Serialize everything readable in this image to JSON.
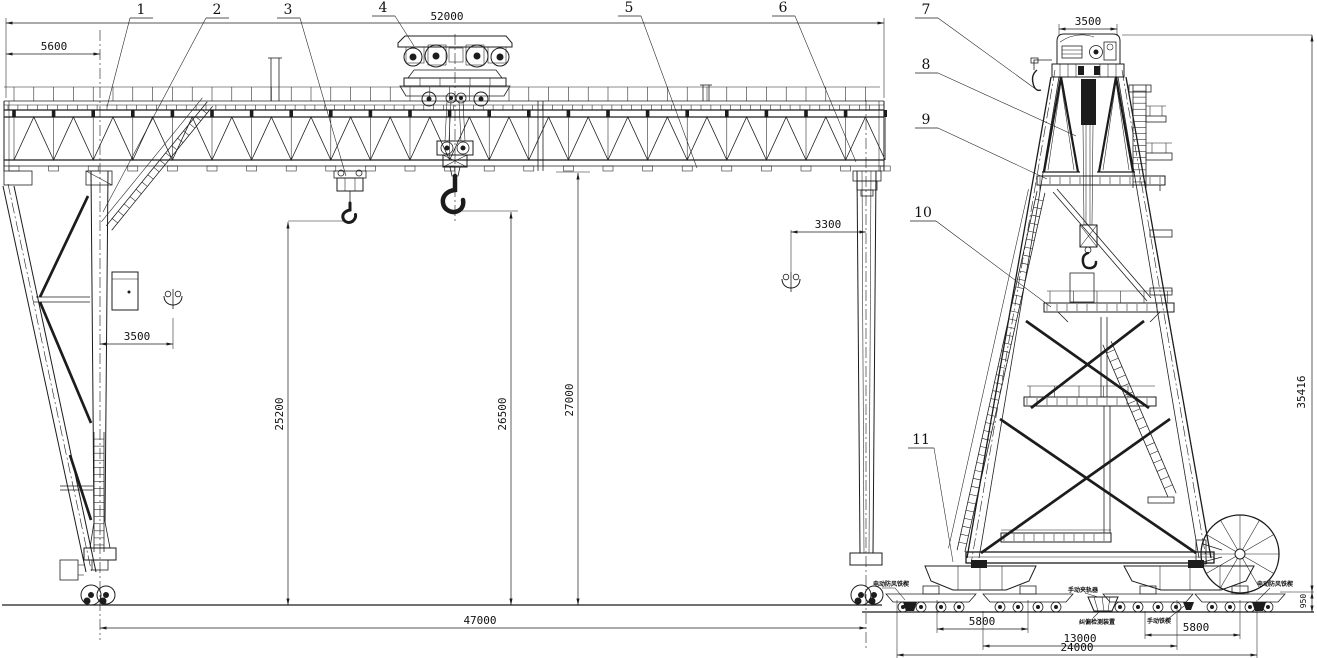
{
  "drawing": {
    "type": "gantry-crane-general-arrangement",
    "ink_color": "#1c1c1c",
    "background": "#ffffff"
  },
  "callouts": {
    "c1": "1",
    "c2": "2",
    "c3": "3",
    "c4": "4",
    "c5": "5",
    "c6": "6",
    "c7": "7",
    "c8": "8",
    "c9": "9",
    "c10": "10",
    "c11": "11"
  },
  "dims": {
    "girder_span": "52000",
    "cantilever": "5600",
    "hook_approach_left": "3500",
    "hook_approach_right": "3300",
    "lift_height_aux": "25200",
    "lift_height_main": "26500",
    "clearance_under_girder": "27000",
    "span_rail": "47000",
    "trolley_gauge": "3500",
    "overall_height": "35416",
    "bogie_wheelbase_left": "5800",
    "truck_centers": "13000",
    "base_length": "24000",
    "bogie_wheelbase_right": "5800",
    "rail_height": "950"
  },
  "labels": {
    "anti_wind_left": "电动防风铁楔",
    "manual_rail_clamp": "手动夹轨器",
    "deviation_device": "纠偏检测装置",
    "manual_wedge": "手动铁楔",
    "anti_wind_right": "电动防风铁楔"
  }
}
